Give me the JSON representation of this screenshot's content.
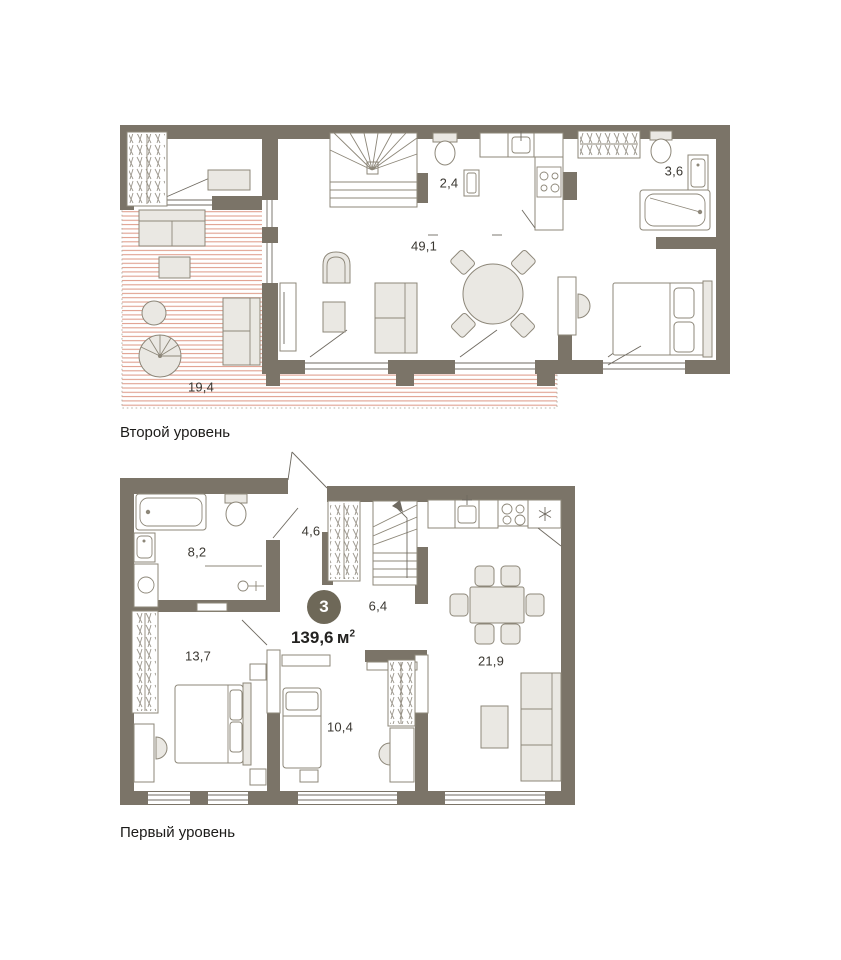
{
  "badge": {
    "number": "3",
    "area_value": "139,6",
    "area_unit": "м",
    "area_exponent": "2"
  },
  "levels": {
    "second": {
      "caption": "Второй уровень",
      "rooms": {
        "living_kitchen": {
          "label": "49,1"
        },
        "wc": {
          "label": "2,4"
        },
        "bathroom": {
          "label": "3,6"
        },
        "terrace": {
          "label": "19,4"
        }
      }
    },
    "first": {
      "caption": "Первый уровень",
      "rooms": {
        "hallway": {
          "label": "4,6"
        },
        "bathroom": {
          "label": "8,2"
        },
        "stair_hall": {
          "label": "6,4"
        },
        "bedroom_main": {
          "label": "13,7"
        },
        "bedroom_second": {
          "label": "10,4"
        },
        "living_kitchen": {
          "label": "21,9"
        }
      }
    }
  },
  "colors": {
    "wall": "#7b7468",
    "furniture_fill": "#eae8e3",
    "furniture_stroke": "#8d8779",
    "terrace_hatch": "#e0a08f",
    "badge_background": "#6e6858",
    "badge_text": "#ffffff",
    "label_text": "#3a3731"
  }
}
